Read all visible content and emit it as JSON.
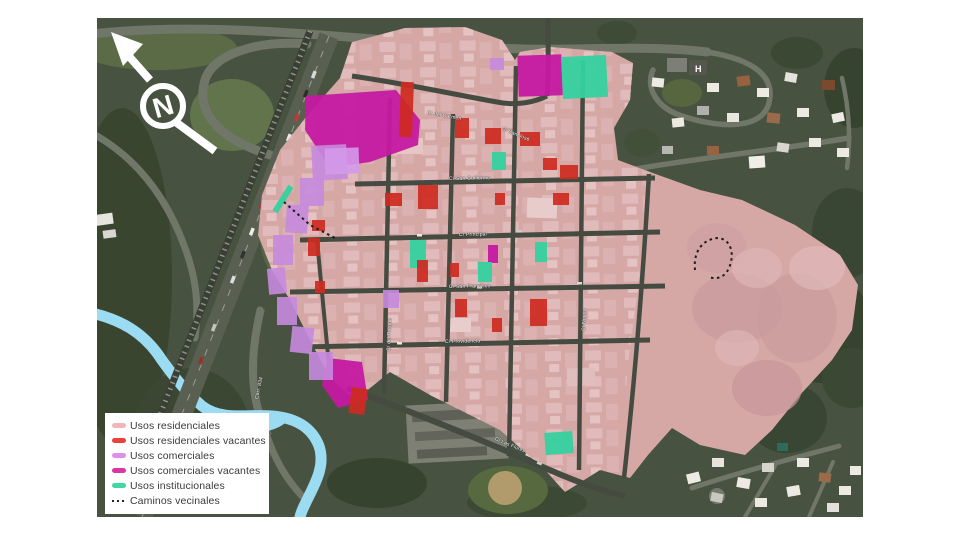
{
  "map": {
    "compass": {
      "letter": "N"
    },
    "helipad_label": "H",
    "legend": {
      "items": [
        {
          "label": "Usos residenciales",
          "color": "#f2b6b8",
          "type": "swatch"
        },
        {
          "label": "Usos residenciales vacantes",
          "color": "#e8423a",
          "type": "swatch"
        },
        {
          "label": "Usos comerciales",
          "color": "#dd90ea",
          "type": "swatch"
        },
        {
          "label": "Usos comerciales vacantes",
          "color": "#d936a6",
          "type": "swatch"
        },
        {
          "label": "Usos institucionales",
          "color": "#40d7a4",
          "type": "swatch"
        },
        {
          "label": "Caminos vecinales",
          "color": "#1c1c1c",
          "type": "dotted"
        }
      ]
    },
    "zone_colors": {
      "residential": "#d5a8a6",
      "residential_vacant": "#ce2a20",
      "commercial": "#c78ade",
      "commercial_vacant": "#c519a2",
      "institutional": "#35d19e",
      "paths": "#1c1c1c",
      "river": "#9cdcf2"
    },
    "street_labels": [
      {
        "text": "C/ del Carmen",
        "x": 330,
        "y": 92,
        "rot": 10
      },
      {
        "text": "C/ San José",
        "x": 405,
        "y": 108,
        "rot": 22
      },
      {
        "text": "C/ San Guillermo",
        "x": 352,
        "y": 158,
        "rot": -1
      },
      {
        "text": "C/ Principal",
        "x": 362,
        "y": 214,
        "rot": -1
      },
      {
        "text": "C/ San Francisco",
        "x": 352,
        "y": 266,
        "rot": -1
      },
      {
        "text": "C/ Providencia",
        "x": 348,
        "y": 321,
        "rot": -1
      },
      {
        "text": "C/ Las Flores",
        "x": 398,
        "y": 418,
        "rot": 23
      },
      {
        "text": "C/ del Parque",
        "x": 292,
        "y": 330,
        "rot": -88
      },
      {
        "text": "C/ Nueva",
        "x": 487,
        "y": 310,
        "rot": -88
      },
      {
        "text": "Carr. 834",
        "x": 160,
        "y": 378,
        "rot": -78
      }
    ]
  }
}
